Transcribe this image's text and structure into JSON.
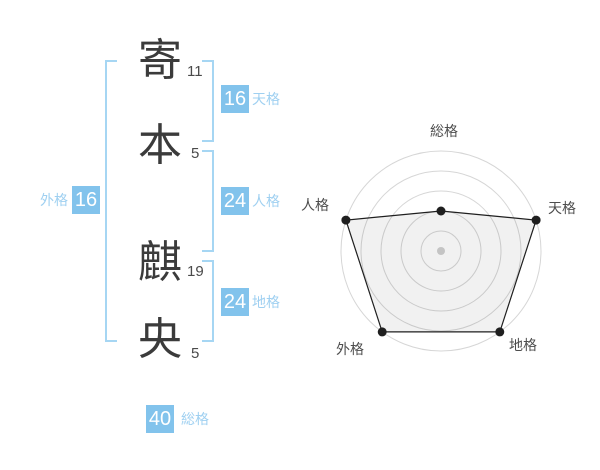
{
  "name": {
    "characters": [
      {
        "char": "寄",
        "strokes": "11"
      },
      {
        "char": "本",
        "strokes": "5"
      },
      {
        "char": "麒",
        "strokes": "19"
      },
      {
        "char": "央",
        "strokes": "5"
      }
    ]
  },
  "scores": {
    "tenkaku": {
      "label": "天格",
      "value": "16"
    },
    "jinkaku": {
      "label": "人格",
      "value": "24"
    },
    "chikaku": {
      "label": "地格",
      "value": "24"
    },
    "gaikaku": {
      "label": "外格",
      "value": "16"
    },
    "soukaku": {
      "label": "総格",
      "value": "40"
    }
  },
  "colors": {
    "box_blue": "#82c3ec",
    "label_blue": "#9fd0f1",
    "bracket_blue": "#a6d6f3",
    "kanji_dark": "#3b3b3b",
    "radar_label": "#4d4d4d",
    "radar_grid": "#d6d6d6",
    "radar_line": "#1f1f1f",
    "radar_fill": "rgba(0,0,0,0.055)",
    "radar_center_dot": "#c4c4c4"
  },
  "chart_data": {
    "type": "radar",
    "categories": [
      "総格",
      "天格",
      "地格",
      "外格",
      "人格"
    ],
    "values": [
      2,
      5,
      5,
      5,
      5
    ],
    "axis_max": 5,
    "rings": 5,
    "grid": "circular",
    "legend": "none"
  }
}
